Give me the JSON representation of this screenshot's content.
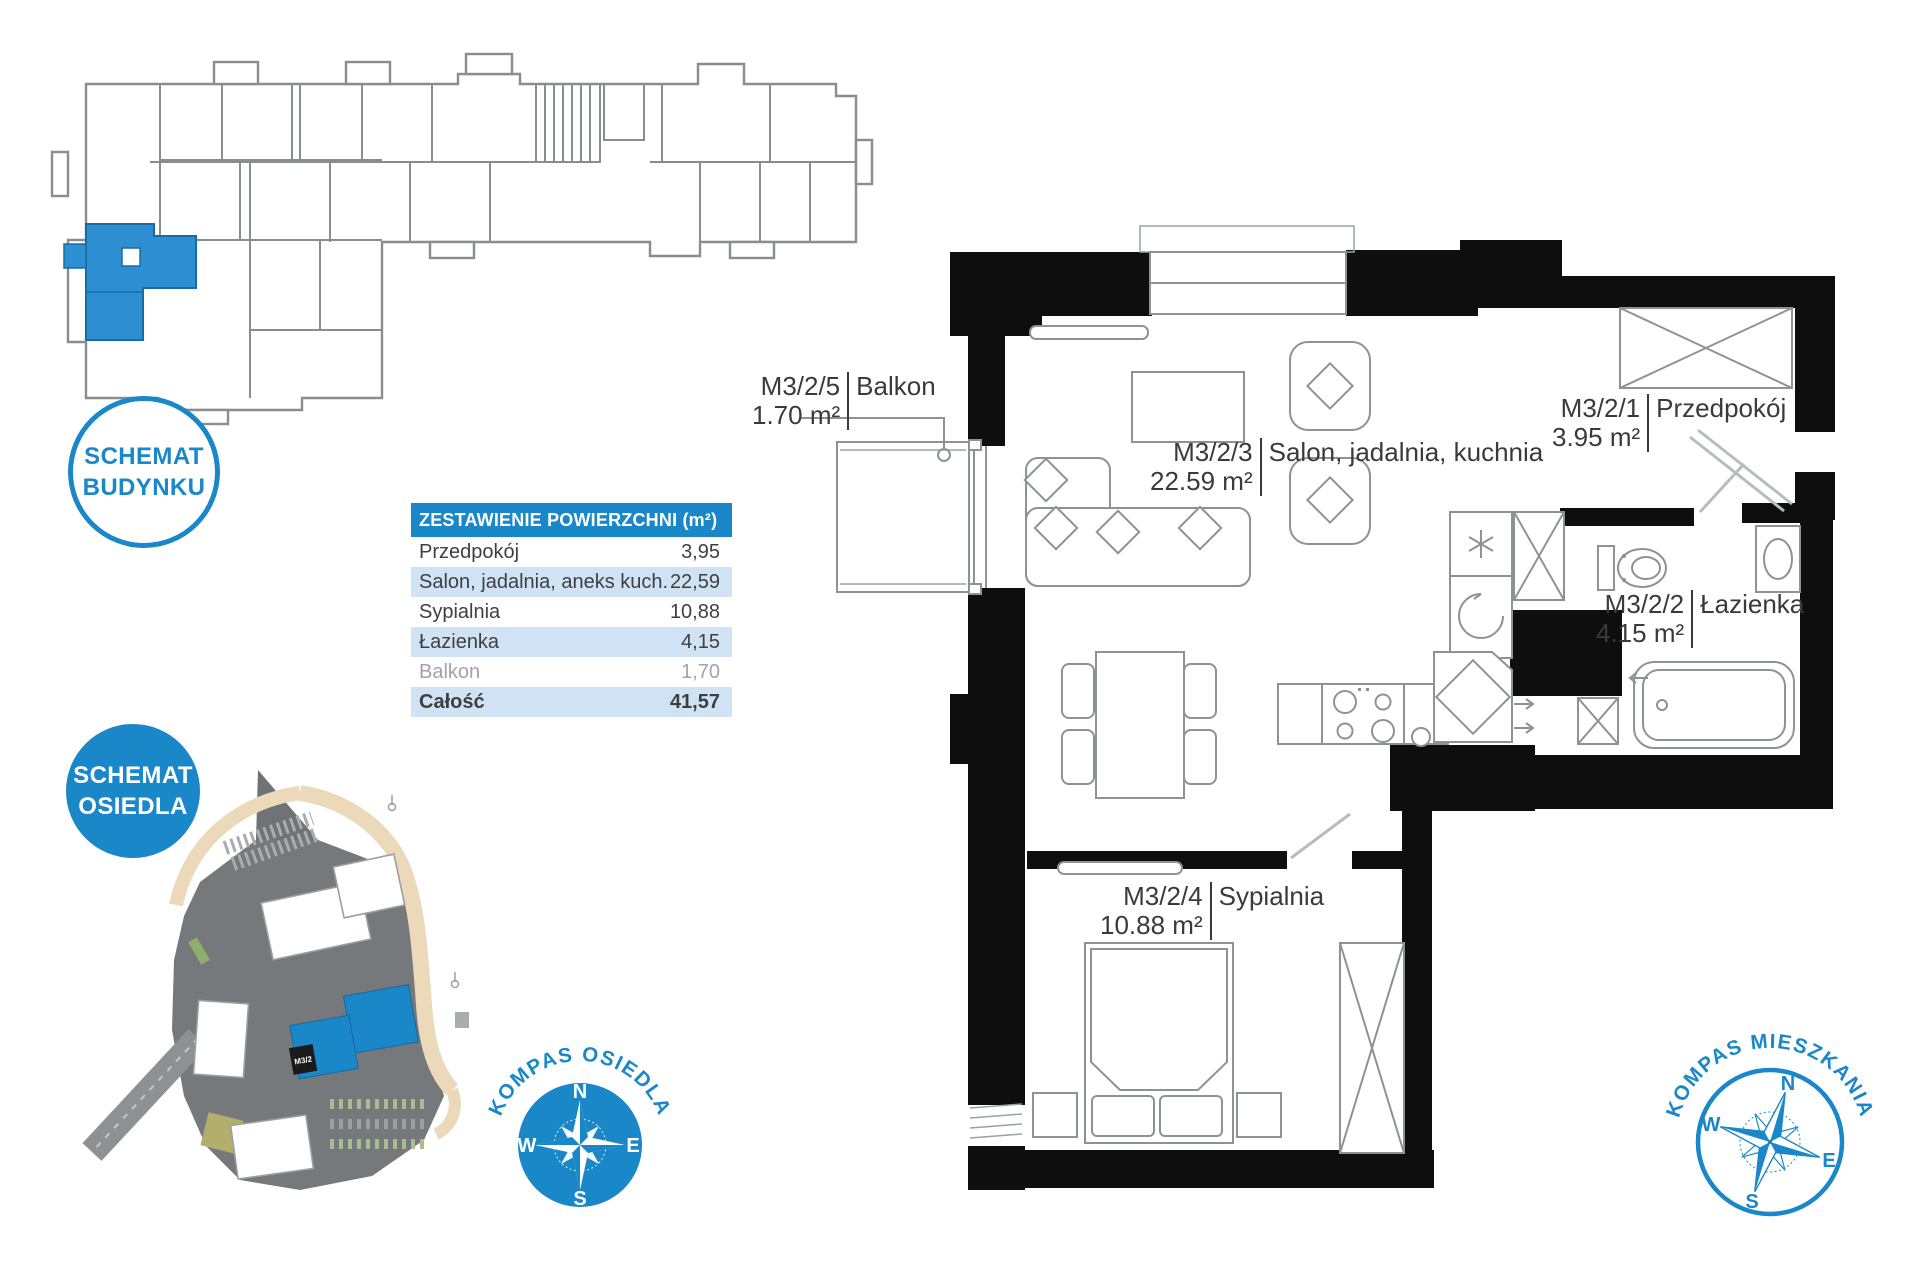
{
  "colors": {
    "accent": "#1a87c8",
    "accent_deep": "#15699b",
    "row_alt": "#cfe3f5",
    "wall": "#0e0e0e",
    "plan_line": "#8f9295",
    "text_dark": "#3a3a3a",
    "muted_text": "#a3a3a3"
  },
  "badges": {
    "building": {
      "line1": "SCHEMAT",
      "line2": "BUDYNKU"
    },
    "estate": {
      "line1": "SCHEMAT",
      "line2": "OSIEDLA"
    }
  },
  "area_table": {
    "title": "ZESTAWIENIE POWIERZCHNI (m²)",
    "rows": [
      {
        "label": "Przedpokój",
        "value": "3,95"
      },
      {
        "label": "Salon, jadalnia, aneks kuch.",
        "value": "22,59"
      },
      {
        "label": "Sypialnia",
        "value": "10,88"
      },
      {
        "label": "Łazienka",
        "value": "4,15"
      },
      {
        "label": "Balkon",
        "value": "1,70"
      },
      {
        "label": "Całość",
        "value": "41,57"
      }
    ]
  },
  "rooms": [
    {
      "code": "M3/2/5",
      "area": "1.70 m²",
      "name": "Balkon"
    },
    {
      "code": "M3/2/3",
      "area": "22.59 m²",
      "name": "Salon, jadalnia, kuchnia"
    },
    {
      "code": "M3/2/1",
      "area": "3.95 m²",
      "name": "Przedpokój"
    },
    {
      "code": "M3/2/2",
      "area": "4.15 m²",
      "name": "Łazienka"
    },
    {
      "code": "M3/2/4",
      "area": "10.88 m²",
      "name": "Sypialnia"
    }
  ],
  "compasses": {
    "directions": {
      "n": "N",
      "e": "E",
      "s": "S",
      "w": "W"
    },
    "estate_label": "KOMPAS OSIEDLA",
    "apartment_label": "KOMPAS MIESZKANIA"
  },
  "estate_map": {
    "unit_tag": "M3/2"
  }
}
